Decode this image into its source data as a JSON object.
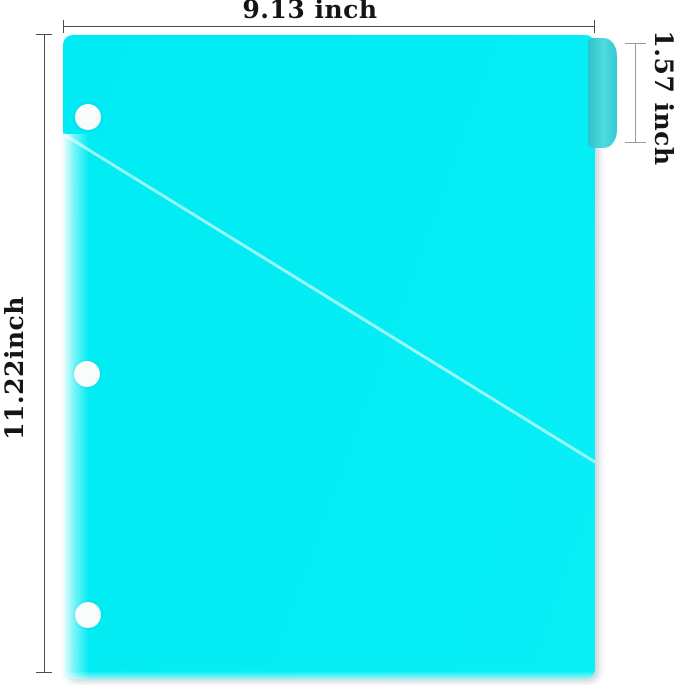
{
  "diagram": {
    "type": "product-dimension-diagram",
    "dimensions": {
      "width_label": "9.13 inch",
      "height_label": "11.22inch",
      "tab_label": "1.57 inch"
    },
    "features": {
      "hole_count": 3
    }
  },
  "colors": {
    "background": "#ffffff",
    "folder": "#00ebf3",
    "tab": "#33d4da",
    "hole": "#fafbfb",
    "dim_line": "#4a4a4a",
    "dim_line_light": "#9a9a9a",
    "label_text": "#151515"
  }
}
